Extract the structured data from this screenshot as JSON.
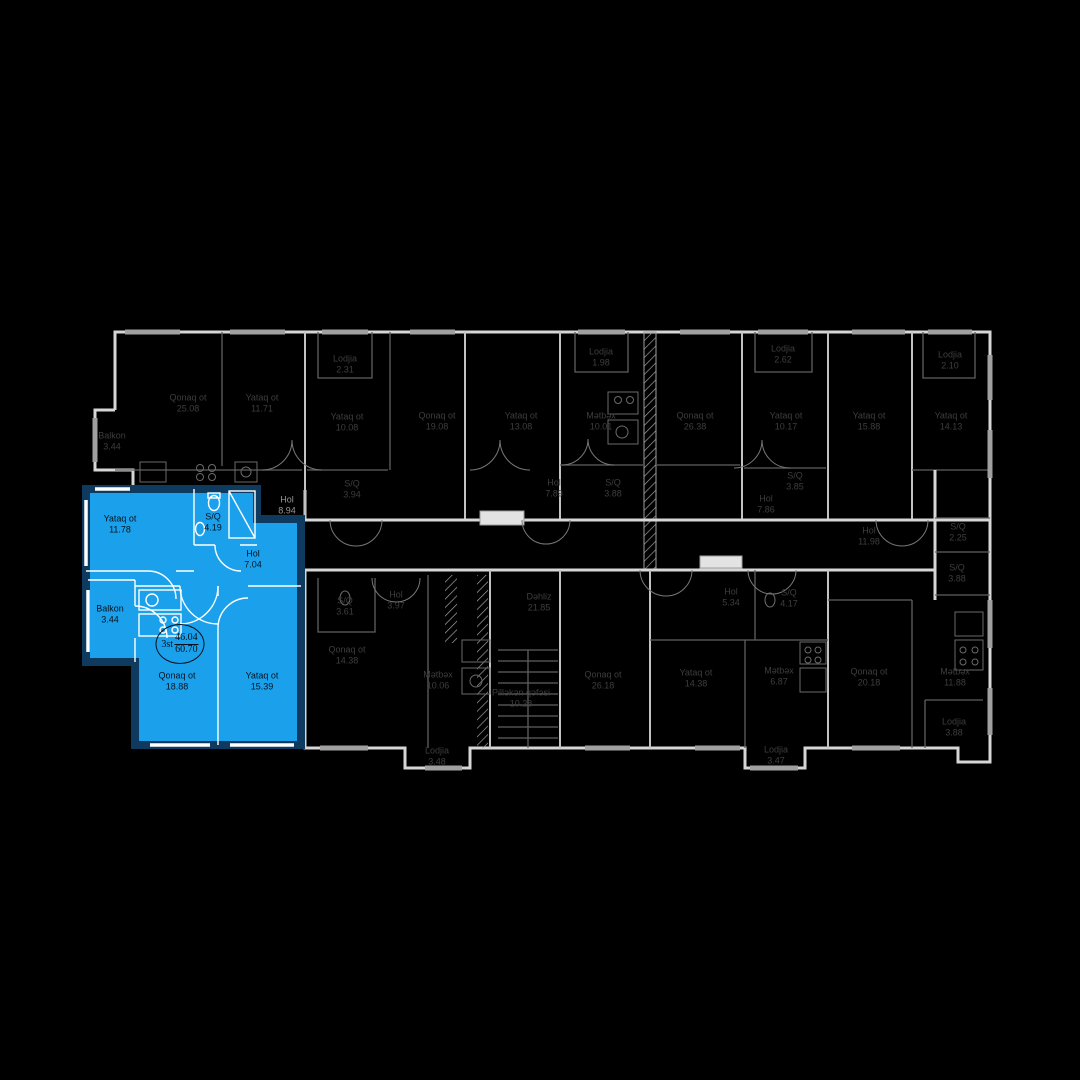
{
  "plan_title": "floor-plan",
  "colors": {
    "background": "#000000",
    "highlight_fill": "#1ba1ec",
    "highlight_outline": "#0d3a5e",
    "walls_outer": "#d6d6d6",
    "walls_inner": "#5f5f5f",
    "label_dim": "#3e3e3e",
    "label_light": "#979797",
    "label_selected": "#06121d"
  },
  "selected_unit": {
    "fill": "#1ba1ec",
    "badge": {
      "floor": "3st",
      "upper_area": "46.04",
      "lower_area": "60.70"
    },
    "rooms": [
      {
        "name": "Yataq ot",
        "area": "11.78"
      },
      {
        "name": "S/Q",
        "area": "4.19"
      },
      {
        "name": "Hol",
        "area": "7.04"
      },
      {
        "name": "Balkon",
        "area": "3.44"
      },
      {
        "name": "Qonaq ot",
        "area": "18.88"
      },
      {
        "name": "Yataq ot",
        "area": "15.39"
      }
    ]
  },
  "floor_rooms": [
    {
      "name": "Qonaq ot",
      "area": "25.08"
    },
    {
      "name": "Yataq ot",
      "area": "11.71"
    },
    {
      "name": "Balkon",
      "area": "3.44"
    },
    {
      "name": "Hol",
      "area": "8.94"
    },
    {
      "name": "Lodjia",
      "area": "2.31"
    },
    {
      "name": "Yataq ot",
      "area": "10.08"
    },
    {
      "name": "S/Q",
      "area": "3.94"
    },
    {
      "name": "Qonaq ot",
      "area": "19.08"
    },
    {
      "name": "Yataq ot",
      "area": "13.08"
    },
    {
      "name": "Hol",
      "area": "7.89"
    },
    {
      "name": "Lodjia",
      "area": "1.98"
    },
    {
      "name": "Mətbəx",
      "area": "10.01"
    },
    {
      "name": "S/Q",
      "area": "3.88"
    },
    {
      "name": "Qonaq ot",
      "area": "26.38"
    },
    {
      "name": "Lodjia",
      "area": "2.62"
    },
    {
      "name": "Yataq ot",
      "area": "10.17"
    },
    {
      "name": "S/Q",
      "area": "3.85"
    },
    {
      "name": "Hol",
      "area": "7.86"
    },
    {
      "name": "Yataq ot",
      "area": "15.88"
    },
    {
      "name": "Lodjia",
      "area": "2.10"
    },
    {
      "name": "Yataq ot",
      "area": "14.13"
    },
    {
      "name": "Hol",
      "area": "11.98"
    },
    {
      "name": "S/Q",
      "area": "2.25"
    },
    {
      "name": "S/Q",
      "area": "3.88"
    },
    {
      "name": "S/Q",
      "area": "3.61"
    },
    {
      "name": "Hol",
      "area": "3.97"
    },
    {
      "name": "Qonaq ot",
      "area": "14.38"
    },
    {
      "name": "Mətbəx",
      "area": "10.06"
    },
    {
      "name": "Lodjia",
      "area": "3.48"
    },
    {
      "name": "Dəhliz",
      "area": "21.85"
    },
    {
      "name": "Pilləkən qəfəsi",
      "area": "10.28"
    },
    {
      "name": "Qonaq ot",
      "area": "26.18"
    },
    {
      "name": "Yataq ot",
      "area": "14.38"
    },
    {
      "name": "Hol",
      "area": "5.34"
    },
    {
      "name": "S/Q",
      "area": "4.17"
    },
    {
      "name": "Mətbəx",
      "area": "6.87"
    },
    {
      "name": "Lodjia",
      "area": "3.47"
    },
    {
      "name": "Qonaq ot",
      "area": "20.18"
    },
    {
      "name": "Mətbəx",
      "area": "11.88"
    },
    {
      "name": "Lodjia",
      "area": "3.88"
    }
  ]
}
